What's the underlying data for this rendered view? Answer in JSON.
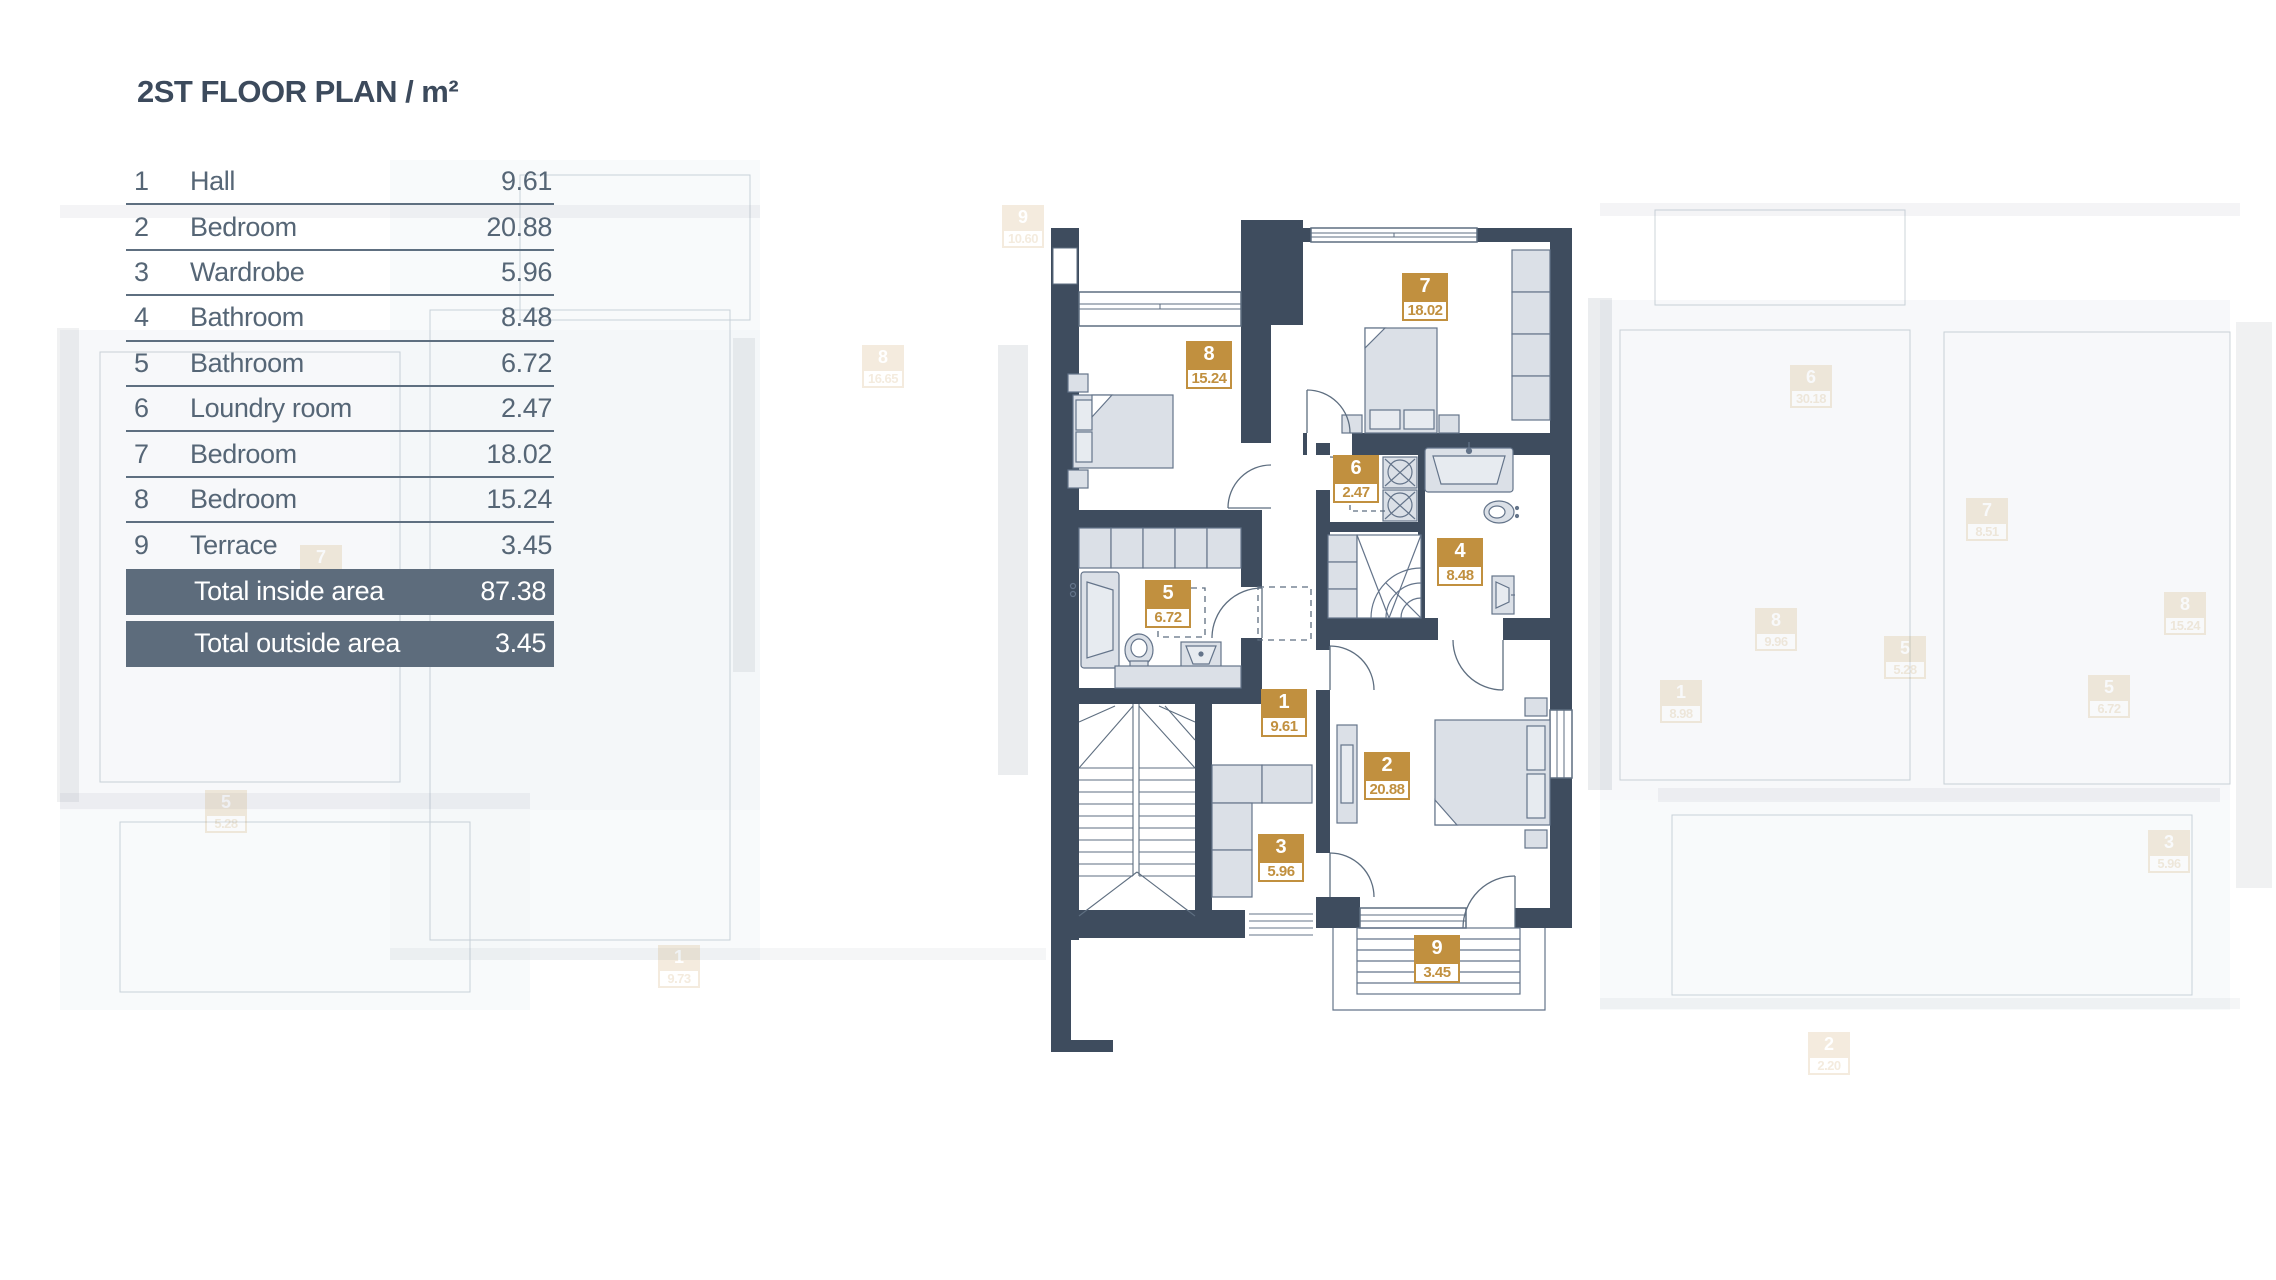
{
  "title": "2ST FLOOR PLAN / m²",
  "legend": {
    "rows": [
      {
        "num": "1",
        "name": "Hall",
        "area": "9.61"
      },
      {
        "num": "2",
        "name": "Bedroom",
        "area": "20.88"
      },
      {
        "num": "3",
        "name": "Wardrobe",
        "area": "5.96"
      },
      {
        "num": "4",
        "name": "Bathroom",
        "area": "8.48"
      },
      {
        "num": "5",
        "name": "Bathroom",
        "area": "6.72"
      },
      {
        "num": "6",
        "name": "Loundry room",
        "area": "2.47"
      },
      {
        "num": "7",
        "name": "Bedroom",
        "area": "18.02"
      },
      {
        "num": "8",
        "name": "Bedroom",
        "area": "15.24"
      },
      {
        "num": "9",
        "name": "Terrace",
        "area": "3.45"
      }
    ],
    "totals": [
      {
        "label": "Total inside area",
        "value": "87.38"
      },
      {
        "label": "Total outside area",
        "value": "3.45"
      }
    ]
  },
  "plan": {
    "badges": [
      {
        "num": "1",
        "area": "9.61"
      },
      {
        "num": "2",
        "area": "20.88"
      },
      {
        "num": "3",
        "area": "5.96"
      },
      {
        "num": "4",
        "area": "8.48"
      },
      {
        "num": "5",
        "area": "6.72"
      },
      {
        "num": "6",
        "area": "2.47"
      },
      {
        "num": "7",
        "area": "18.02"
      },
      {
        "num": "8",
        "area": "15.24"
      },
      {
        "num": "9",
        "area": "3.45"
      }
    ]
  },
  "watermark": {
    "badges": [
      {
        "num": "9",
        "area": "10.60"
      },
      {
        "num": "8",
        "area": "16.65"
      },
      {
        "num": "7",
        "area": "8.51"
      },
      {
        "num": "5",
        "area": "5.28"
      },
      {
        "num": "1",
        "area": "9.73"
      },
      {
        "num": "7",
        "area": "8.51"
      },
      {
        "num": "5",
        "area": "5.28"
      },
      {
        "num": "1",
        "area": "8.98"
      },
      {
        "num": "5",
        "area": "6.72"
      },
      {
        "num": "8",
        "area": "9.96"
      },
      {
        "num": "8",
        "area": "15.24"
      },
      {
        "num": "6",
        "area": "30.18"
      },
      {
        "num": "2",
        "area": "2.20"
      },
      {
        "num": "3",
        "area": "5.96"
      }
    ]
  },
  "colors": {
    "wall": "#3E4C5E",
    "accent_gold": "#C1903F",
    "table_text": "#566676",
    "totals_bg": "#5D6C7C",
    "title_text": "#3C4A5C"
  }
}
